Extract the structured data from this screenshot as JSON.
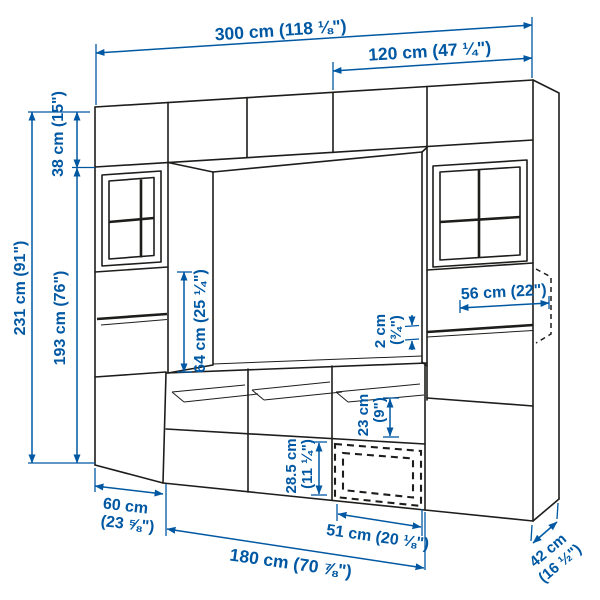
{
  "colors": {
    "accent": "#0058a3",
    "line": "#1d1d1b",
    "background": "#ffffff"
  },
  "diagram": {
    "kind": "furniture dimension line drawing",
    "subject": "TV storage combination with glass doors",
    "labels": {
      "total_width": "300 cm (118 ⅛\")",
      "right_section_width": "120 cm (47 ¼\")",
      "total_height": "231 cm (91\")",
      "cabinet_height": "193 cm (76\")",
      "top_cabinet_height": "38 cm (15\")",
      "tv_opening_height": "64 cm (25 ¼\")",
      "shelf_width": "56 cm (22\")",
      "shelf_thickness_value": "2 cm",
      "shelf_thickness_imperial": "(¾\")",
      "open_compartment_value": "23 cm",
      "open_compartment_imperial": "(9\")",
      "drawer_front_value": "28.5 cm",
      "drawer_front_imperial": "(11 ¼\")",
      "drawer_width": "51 cm (20 ⅛\")",
      "side_cabinet_value": "60 cm",
      "side_cabinet_imperial": "(23 ⅝\")",
      "tv_bench_width": "180 cm (70 ⅞\")",
      "depth_value": "42 cm",
      "depth_imperial": "(16 ½\")"
    }
  }
}
